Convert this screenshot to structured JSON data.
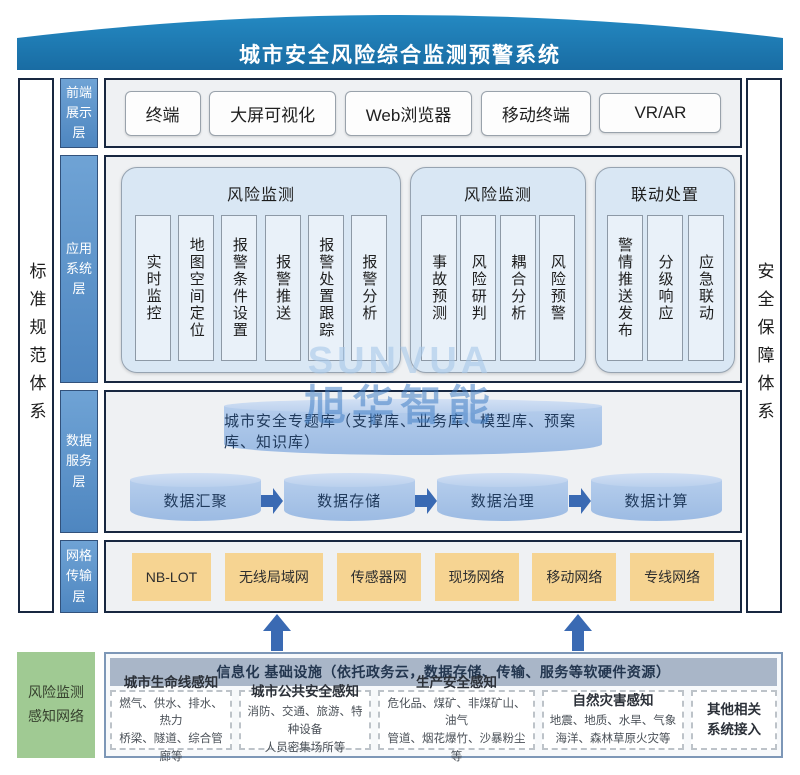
{
  "banner": {
    "title": "城市安全风险综合监测预警系统"
  },
  "watermark": {
    "latin": "SUNVUA",
    "cjk": "旭华智能"
  },
  "sides": {
    "left": "标准规范体系",
    "right": "安全保障体系"
  },
  "layers": {
    "front": {
      "tab": "前端\n展示\n层",
      "items": [
        "终端",
        "大屏可视化",
        "Web浏览器",
        "移动终端",
        "VR/AR"
      ]
    },
    "app": {
      "tab": "应用\n系统\n层",
      "groups": [
        {
          "title": "风险监测",
          "items": [
            "实时监控",
            "地图空间定位",
            "报警条件设置",
            "报警推送",
            "报警处置跟踪",
            "报警分析"
          ]
        },
        {
          "title": "风险监测",
          "items": [
            "事故预测",
            "风险研判",
            "耦合分析",
            "风险预警"
          ]
        },
        {
          "title": "联动处置",
          "items": [
            "警情推送发布",
            "分级响应",
            "应急联动"
          ]
        }
      ]
    },
    "data": {
      "tab": "数据\n服务\n层",
      "repository": "城市安全专题库（支撑库、业务库、模型库、预案库、知识库）",
      "flow": [
        "数据汇聚",
        "数据存储",
        "数据治理",
        "数据计算"
      ]
    },
    "network": {
      "tab": "网格\n传输\n层",
      "items": [
        "NB-LOT",
        "无线局域网",
        "传感器网",
        "现场网络",
        "移动网络",
        "专线网络"
      ]
    }
  },
  "bottom": {
    "side_label": "风险监测\n感知网络",
    "header": "信息化 基础设施（依托政务云，数据存储、传输、服务等软硬件资源）",
    "boxes": [
      {
        "title": "城市生命线感知",
        "desc": "燃气、供水、排水、热力\n桥梁、隧道、综合管廊等"
      },
      {
        "title": "城市公共安全感知",
        "desc": "消防、交通、旅游、特种设备\n人员密集场所等"
      },
      {
        "title": "生产安全感知",
        "desc": "危化品、煤矿、非煤矿山、油气\n管道、烟花爆竹、沙暴粉尘等"
      },
      {
        "title": "自然灾害感知",
        "desc": "地震、地质、水旱、气象\n海洋、森林草原火灾等"
      },
      {
        "title": "其他相关\n系统接入",
        "desc": ""
      }
    ]
  },
  "colors": {
    "banner_blue": "#1e79b0",
    "tab_blue": "#5c93c9",
    "panel_gray": "#eff1f3",
    "group_blue": "#d9e7f4",
    "item_blue": "#e9f1f9",
    "cylinder_blue": "#a9c4e7",
    "arrow_blue": "#3a6ab3",
    "network_tan": "#f6d492",
    "sensing_green": "#a0ca93",
    "infra_header_gray": "#a9b6c8",
    "border_navy": "#182740"
  }
}
